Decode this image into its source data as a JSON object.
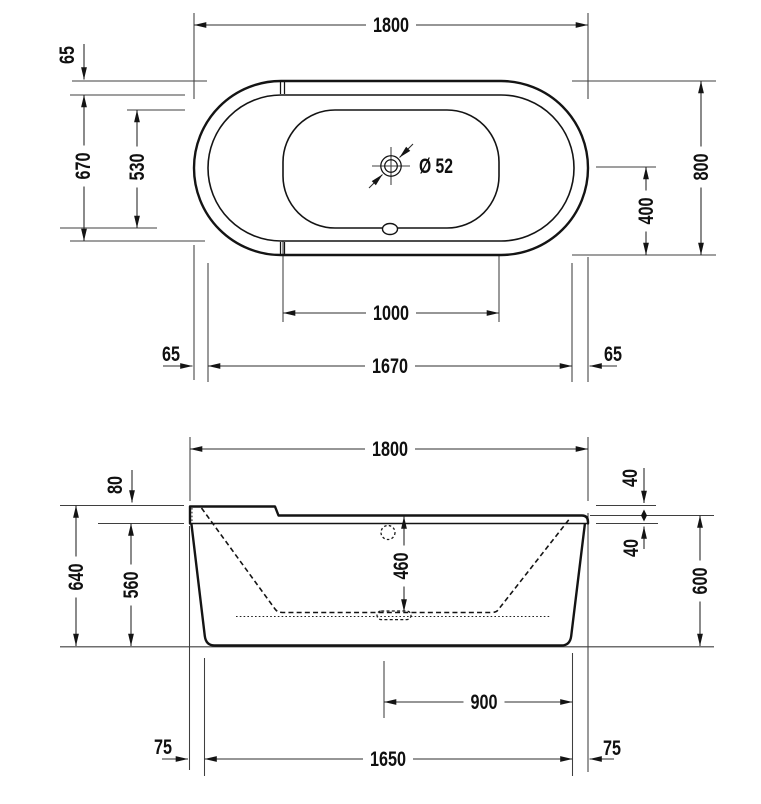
{
  "colors": {
    "line": "#1a1a1a",
    "background": "#ffffff"
  },
  "views": {
    "plan": {
      "dims": {
        "overall_length": "1800",
        "rim_top": "65",
        "inner_width": "670",
        "basin_width": "530",
        "overall_width": "800",
        "drain_center_offset": "400",
        "basin_length": "1000",
        "inner_length": "1670",
        "rim_left": "65",
        "rim_right": "65",
        "drain_diameter": "Ø 52"
      }
    },
    "front": {
      "dims": {
        "overall_length": "1800",
        "backrest_rise": "80",
        "backrest_height": "640",
        "rim_underside_height": "560",
        "rim_step": "40",
        "rim_thickness": "40",
        "rim_height": "600",
        "inner_depth": "460",
        "drain_offset": "900",
        "base_length": "1650",
        "base_inset_left": "75",
        "base_inset_right": "75"
      }
    }
  }
}
